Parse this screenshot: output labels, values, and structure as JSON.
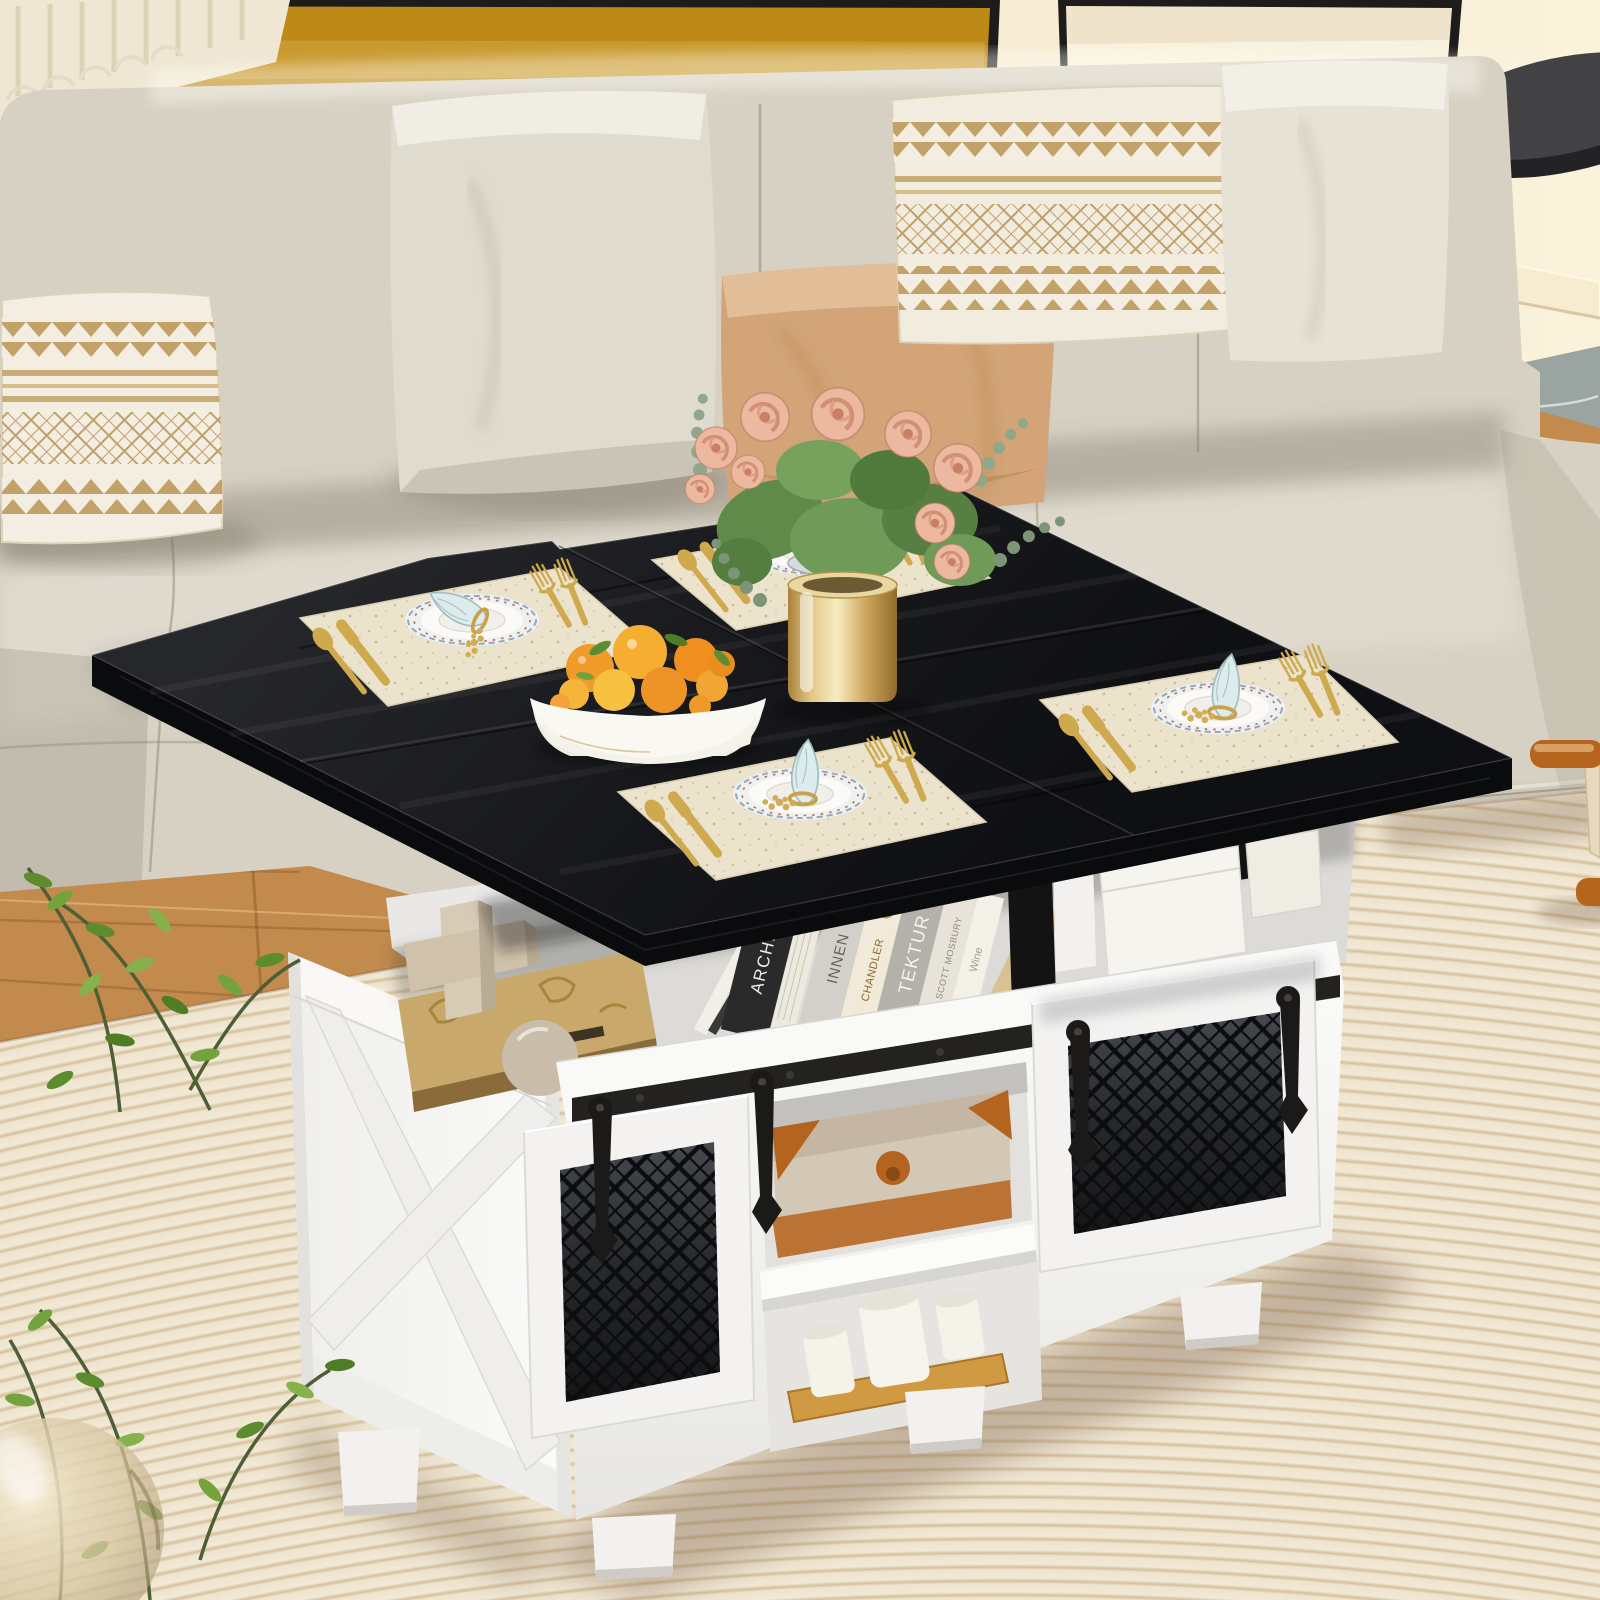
{
  "meta": {
    "type": "product-lifestyle-photo",
    "subject": "Farmhouse lift-top coffee table with black fold-out dining top and white sliding barn-door storage base, staged in a beige living room",
    "width": 1600,
    "height": 1600
  },
  "books": [
    {
      "title": "ARCHIT"
    },
    {
      "title": "INNEN"
    },
    {
      "title": "CHANDLER"
    },
    {
      "title": "TEKTUR"
    },
    {
      "title": "SCOTT MOSBURY"
    },
    {
      "title": "Wine"
    }
  ],
  "objects": {
    "wall_art": [
      "ribbed-relief-art-gold-mat-black-frame",
      "blank-canvas-black-frame"
    ],
    "sofa": "beige-fabric-sectional-with-chaise",
    "pillows": [
      "boho-tan-stripe-lumbar",
      "light-gray-square",
      "camel-velvet",
      "boho-zigzag-lumbar",
      "cream-square"
    ],
    "table": {
      "top": "black-square-fold-out-lift-top",
      "base": "white-farmhouse-cabinet",
      "doors": "two-sliding-mesh-barn-doors",
      "hardware": "black-rail-with-spade-hangers",
      "storage_contents": [
        "architecture-books",
        "wood-burr-puzzle",
        "kraft-box",
        "stone-sphere",
        "white-leather-boxes",
        "beige-trunk-case",
        "three-white-candles-on-bamboo-tray"
      ]
    },
    "tabletop_items": [
      "four-cream-placemats-with-plate-settings",
      "gold-cutlery",
      "blue-folded-napkins",
      "white-bowl-of-citrus-fruit",
      "gold-vase-with-pink-roses-and-eucalyptus"
    ],
    "floor": [
      "oak-wood-floor",
      "cream-ribbed-rug",
      "gray-marble-runner"
    ],
    "other": [
      "green-houseplant",
      "glass-ball-vase",
      "black-round-side-table",
      "wood-frame-chair-edge"
    ]
  },
  "palette": {
    "wall": "#f6ead2",
    "frame_mat": "#bd8a17",
    "sofa": "#d7d1c3",
    "camel_pillow": "#d2a477",
    "tabletop": "#17181b",
    "cabinet": "#f6f5f3",
    "hardware": "#1c1a19",
    "rug": "#efe5d1",
    "rug_stripe": "#d6c19c",
    "wood_floor": "#c28a4d",
    "gold": "#c9a14a",
    "rose": "#e9b49c",
    "orange_fruit": "#f09b2a",
    "leaf_green": "#6fa23c",
    "trunk_accent": "#b5641f"
  }
}
